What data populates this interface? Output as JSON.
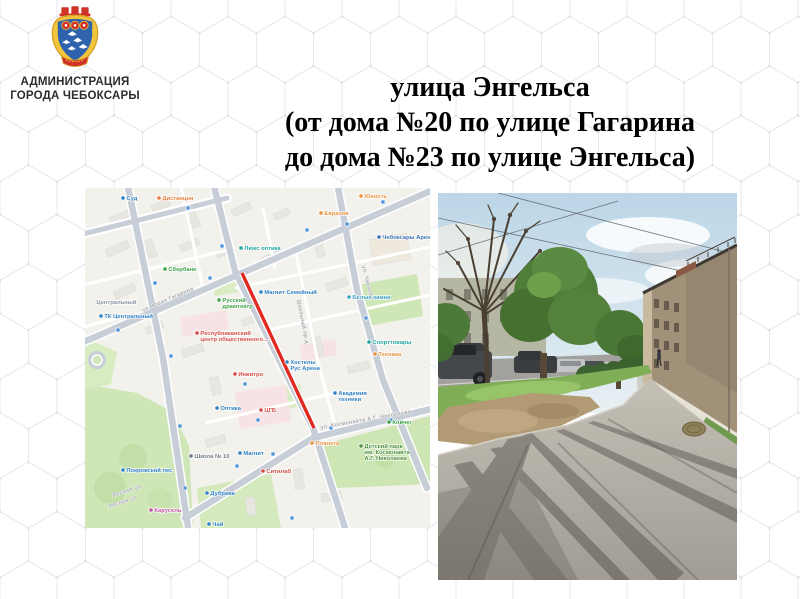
{
  "slide": {
    "org": {
      "line1": "АДМИНИСТРАЦИЯ",
      "line2": "ГОРОДА ЧЕБОКСАРЫ"
    },
    "title": {
      "line1": "улица Энгельса",
      "line2": "(от дома №20 по улице Гагарина",
      "line3": "до дома №23 по улице Энгельса)"
    },
    "emblem_colors": {
      "gold": "#f2c53d",
      "blue": "#2f63ae",
      "red": "#cf3227"
    }
  },
  "map": {
    "highlight_color": "#e02a20",
    "highlight_segment": {
      "x1": 157,
      "y1": 85,
      "x2": 229,
      "y2": 240
    },
    "colors": {
      "background": "#f2f1ec",
      "road": "#c7ced8",
      "park": "#cfe7b6"
    },
    "street_labels": [
      {
        "text": "ул. Юрия Гагарина",
        "x": 58,
        "y": 124,
        "rotate": -23.5
      },
      {
        "text": "ул. Космонавта А.Г. Николаева",
        "x": 236,
        "y": 241,
        "rotate": -10
      },
      {
        "text": "ул. Чапаева",
        "x": 277,
        "y": 78,
        "rotate": 76
      },
      {
        "text": "Школьный пр-д",
        "x": 212,
        "y": 112,
        "rotate": 79
      },
      {
        "text": "Лесная ул",
        "x": 28,
        "y": 309,
        "rotate": -18
      },
      {
        "text": "Лесная ул",
        "x": 24,
        "y": 320,
        "rotate": -18
      }
    ],
    "transit_stops": [
      [
        103,
        20
      ],
      [
        70,
        95
      ],
      [
        86,
        168
      ],
      [
        95,
        238
      ],
      [
        100,
        300
      ],
      [
        33,
        142
      ],
      [
        125,
        90
      ],
      [
        222,
        42
      ],
      [
        298,
        14
      ],
      [
        262,
        36
      ],
      [
        281,
        130
      ],
      [
        306,
        232
      ],
      [
        152,
        278
      ],
      [
        246,
        240
      ],
      [
        160,
        196
      ],
      [
        173,
        232
      ],
      [
        188,
        266
      ],
      [
        137,
        58
      ],
      [
        207,
        330
      ]
    ],
    "poi": [
      {
        "label": "Суд",
        "color": "#2f7fc1",
        "x": 38,
        "y": 10
      },
      {
        "label": "Дистанция",
        "color": "#e87f3e",
        "x": 74,
        "y": 10
      },
      {
        "label": "Юность",
        "color": "#e8913e",
        "x": 276,
        "y": 8
      },
      {
        "label": "Евразия",
        "color": "#e8913e",
        "x": 236,
        "y": 25
      },
      {
        "label": "Чебоксары Арена",
        "color": "#3d6fb5",
        "x": 294,
        "y": 49
      },
      {
        "label": "Люкс оптика",
        "color": "#1fa5a0",
        "x": 156,
        "y": 60
      },
      {
        "label": "Сбербанк",
        "color": "#3fa348",
        "x": 80,
        "y": 81
      },
      {
        "label": "Центральный",
        "color": "#8a94a6",
        "x": 8,
        "y": 114,
        "icon": false
      },
      {
        "label": "ТК Центральный",
        "color": "#2f7fc1",
        "x": 16,
        "y": 128
      },
      {
        "label": "Русский\nдрамтеатр",
        "color": "#3fa348",
        "x": 134,
        "y": 112
      },
      {
        "label": "Магнит Семейный",
        "color": "#2f7fc1",
        "x": 176,
        "y": 104
      },
      {
        "label": "Белые камни",
        "color": "#3d9fc1",
        "x": 264,
        "y": 109
      },
      {
        "label": "Республиканский\nцентр общественного…",
        "color": "#d24a43",
        "x": 112,
        "y": 145
      },
      {
        "label": "Спорттовары",
        "color": "#1fa5a0",
        "x": 284,
        "y": 154
      },
      {
        "label": "Техника",
        "color": "#e8913e",
        "x": 290,
        "y": 166
      },
      {
        "label": "Хостелы\nРус Арена",
        "color": "#2f7fc1",
        "x": 202,
        "y": 174
      },
      {
        "label": "Инвитро",
        "color": "#d24a43",
        "x": 150,
        "y": 186
      },
      {
        "label": "Академия\nтехники",
        "color": "#2f7fc1",
        "x": 250,
        "y": 205
      },
      {
        "label": "Оптика",
        "color": "#2f7fc1",
        "x": 132,
        "y": 220
      },
      {
        "label": "ЦГБ",
        "color": "#d24a43",
        "x": 176,
        "y": 222
      },
      {
        "label": "Ковчег",
        "color": "#3fa348",
        "x": 304,
        "y": 234
      },
      {
        "label": "Планета",
        "color": "#e8913e",
        "x": 227,
        "y": 255
      },
      {
        "label": "Детский парк\nим. Космонавта\nА.Г. Николаева",
        "color": "#4d8f3f",
        "x": 276,
        "y": 258
      },
      {
        "label": "Магнит",
        "color": "#2f7fc1",
        "x": 155,
        "y": 265
      },
      {
        "label": "Школа № 10",
        "color": "#6f7885",
        "x": 106,
        "y": 268
      },
      {
        "label": "Ситилаб",
        "color": "#d24a43",
        "x": 178,
        "y": 283
      },
      {
        "label": "Покровский лес",
        "color": "#2f7fc1",
        "x": 38,
        "y": 282
      },
      {
        "label": "Дубрава",
        "color": "#2f7fc1",
        "x": 122,
        "y": 305
      },
      {
        "label": "Карусель",
        "color": "#c2509e",
        "x": 66,
        "y": 322
      },
      {
        "label": "Чай",
        "color": "#2f7fc1",
        "x": 124,
        "y": 336
      }
    ]
  }
}
